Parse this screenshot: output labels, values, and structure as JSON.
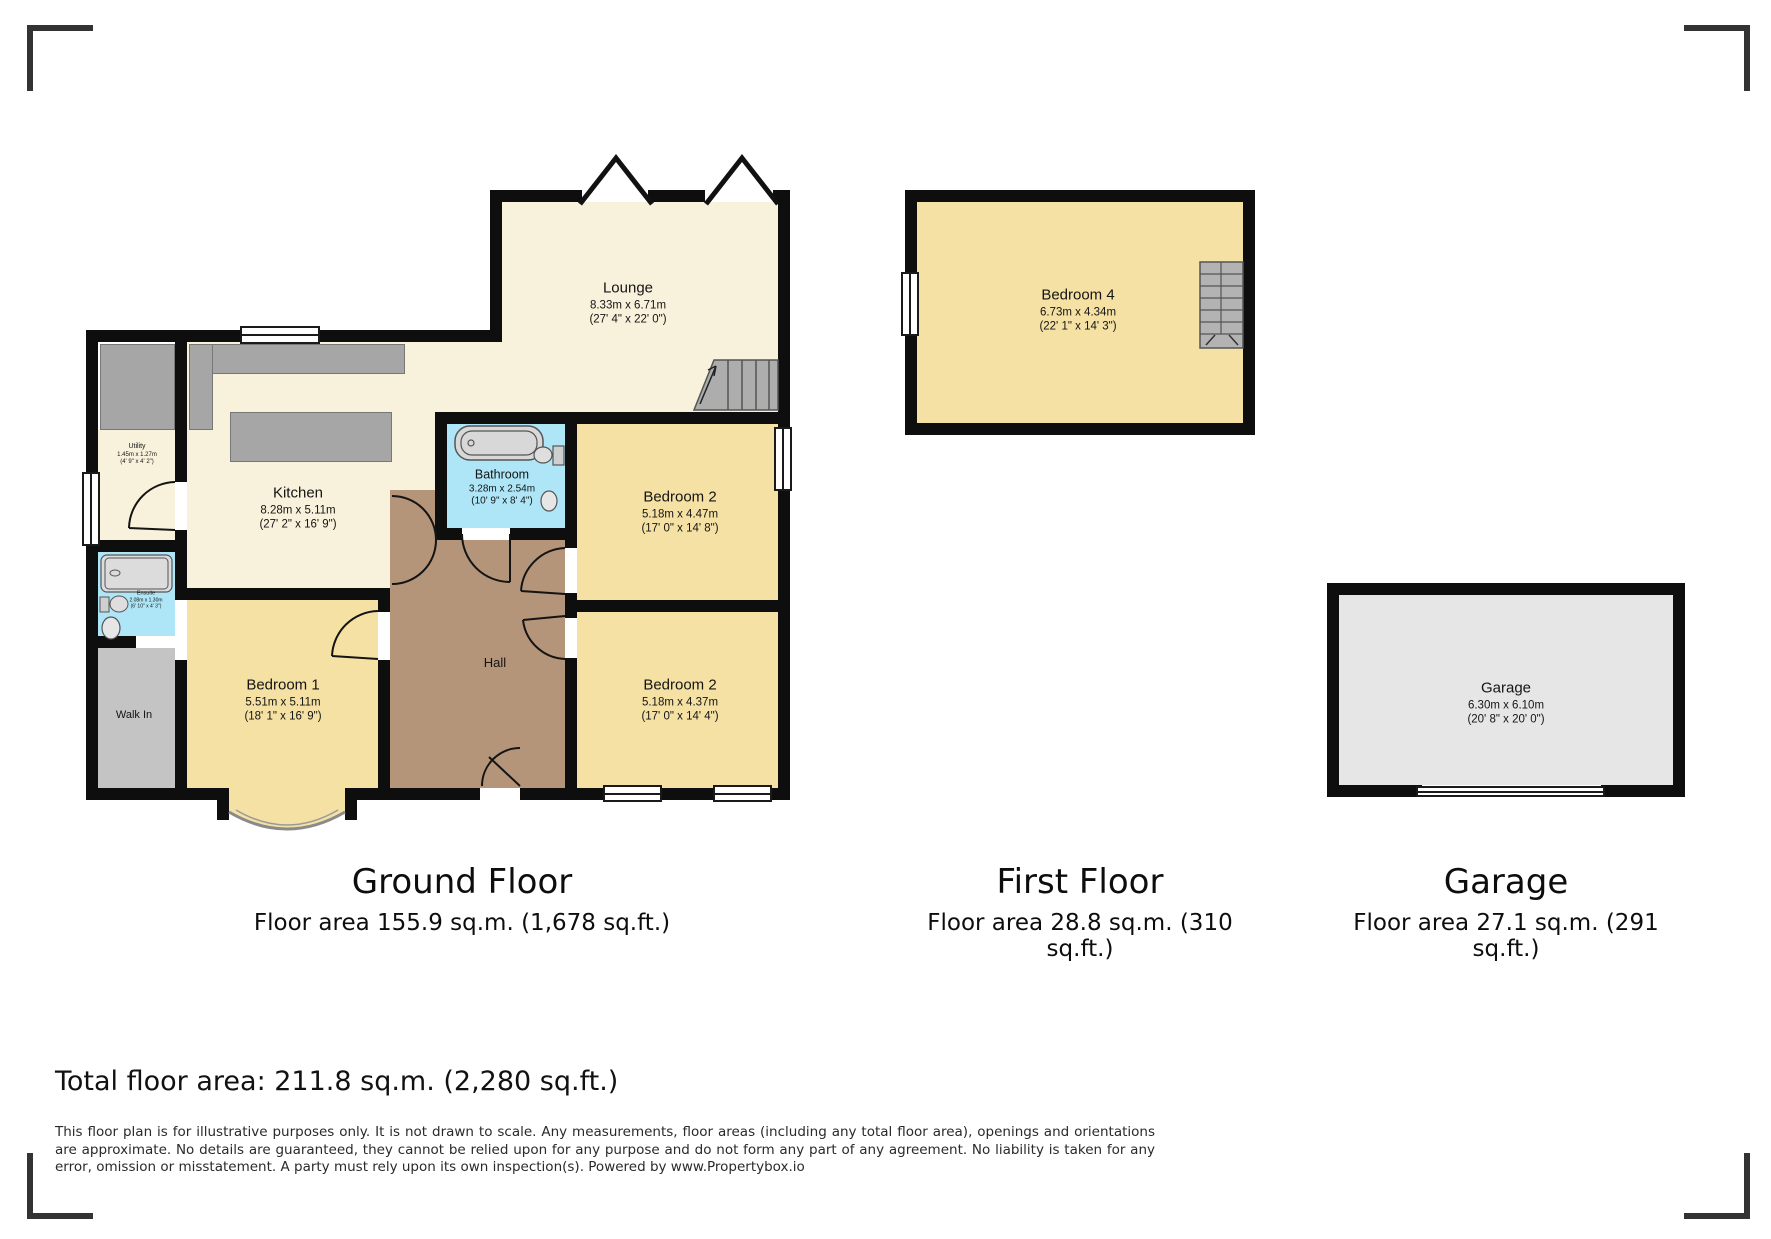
{
  "ground_floor": {
    "title": "Ground Floor",
    "area": "Floor area 155.9 sq.m. (1,678 sq.ft.)",
    "rooms": {
      "lounge": {
        "name": "Lounge",
        "metric": "8.33m x 6.71m",
        "imperial": "(27' 4\" x 22' 0\")"
      },
      "kitchen": {
        "name": "Kitchen",
        "metric": "8.28m x 5.11m",
        "imperial": "(27' 2\" x 16' 9\")"
      },
      "bathroom": {
        "name": "Bathroom",
        "metric": "3.28m x 2.54m",
        "imperial": "(10' 9\" x 8' 4\")"
      },
      "bedroom2a": {
        "name": "Bedroom 2",
        "metric": "5.18m x 4.47m",
        "imperial": "(17' 0\" x 14' 8\")"
      },
      "bedroom2b": {
        "name": "Bedroom 2",
        "metric": "5.18m x 4.37m",
        "imperial": "(17' 0\" x 14' 4\")"
      },
      "bedroom1": {
        "name": "Bedroom 1",
        "metric": "5.51m x 5.11m",
        "imperial": "(18' 1\" x 16' 9\")"
      },
      "hall": {
        "name": "Hall"
      },
      "utility": {
        "name": "Utility",
        "metric": "1.45m x 1.27m",
        "imperial": "(4' 9\" x 4' 2\")"
      },
      "ensuite": {
        "name": "Ensuite",
        "metric": "2.08m x 1.30m",
        "imperial": "(6' 10\" x 4' 3\")"
      },
      "walkin": {
        "name": "Walk In"
      }
    }
  },
  "first_floor": {
    "title": "First Floor",
    "area": "Floor area 28.8 sq.m. (310 sq.ft.)",
    "rooms": {
      "bedroom4": {
        "name": "Bedroom 4",
        "metric": "6.73m x 4.34m",
        "imperial": "(22' 1\" x 14' 3\")"
      }
    }
  },
  "garage": {
    "title": "Garage",
    "area": "Floor area 27.1 sq.m. (291 sq.ft.)",
    "rooms": {
      "garage": {
        "name": "Garage",
        "metric": "6.30m x 6.10m",
        "imperial": "(20' 8\" x 20' 0\")"
      }
    }
  },
  "footer": {
    "total": "Total floor area: 211.8 sq.m. (2,280 sq.ft.)",
    "disclaimer": "This floor plan is for illustrative purposes only. It is not drawn to scale. Any measurements, floor areas (including any total floor area), openings and orientations are approximate. No details are guaranteed, they cannot be relied upon for any purpose and do not form any part of any agreement. No liability is taken for any error, omission or misstatement. A party must rely upon its own inspection(s). Powered by www.Propertybox.io"
  },
  "colors": {
    "wall": "#0e0e0e",
    "cream_floor": "#f8f2dc",
    "bedroom_floor": "#f5e1a4",
    "bathroom_floor": "#aee6f7",
    "hall_floor": "#b49579",
    "counter_gray": "#a6a6a6",
    "walkin_gray": "#c4c4c4",
    "garage_gray": "#e6e6e6"
  }
}
